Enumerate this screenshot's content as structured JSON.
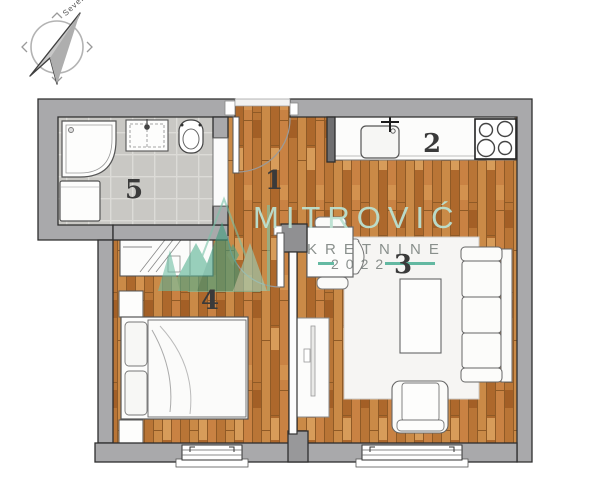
{
  "compass": {
    "label": "Sever"
  },
  "watermark": {
    "brand": "MITROVIĆ",
    "line2": "KRETNINE",
    "year": "2022"
  },
  "rooms": [
    {
      "number": "1",
      "name": "hallway"
    },
    {
      "number": "2",
      "name": "kitchen"
    },
    {
      "number": "3",
      "name": "living-room"
    },
    {
      "number": "4",
      "name": "bedroom"
    },
    {
      "number": "5",
      "name": "bathroom"
    }
  ],
  "colors": {
    "wall_grey": "#a9a9ab",
    "wood_floor": "#c08040",
    "bathroom_tile": "#c9c8c4",
    "watermark_green": "#57b292",
    "accent_teal": "#3fa98c"
  }
}
